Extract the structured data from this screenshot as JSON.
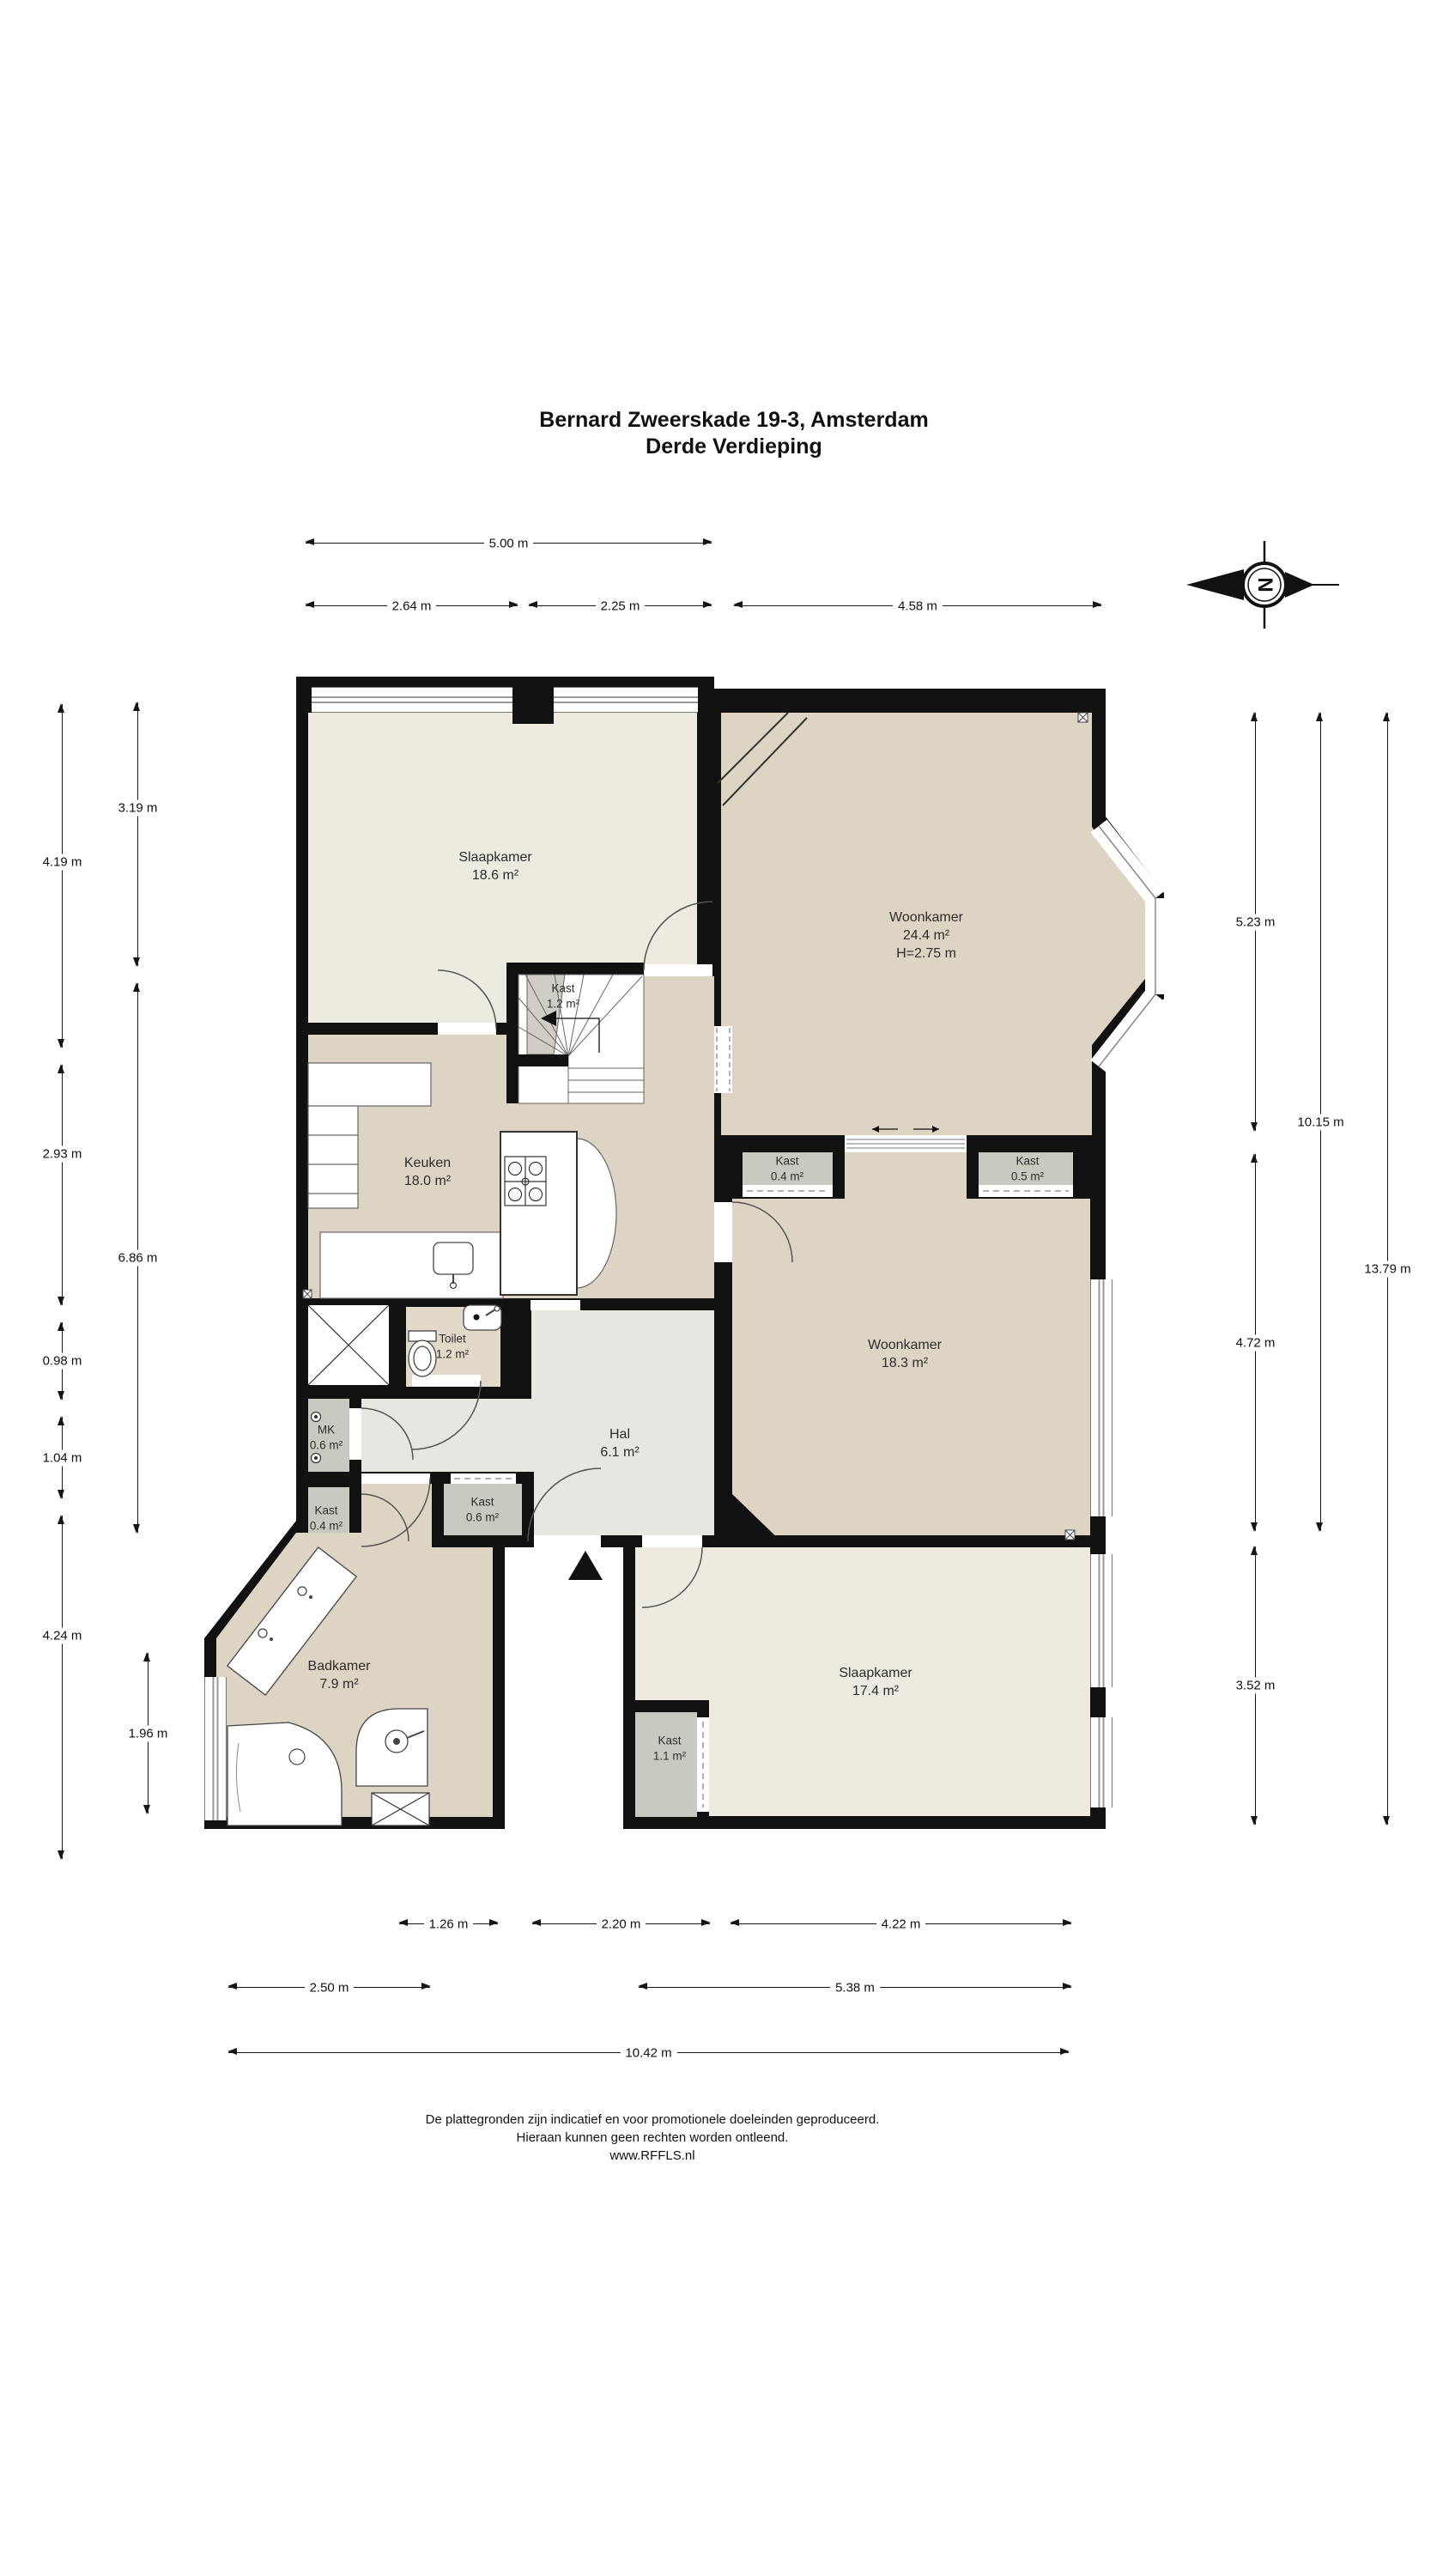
{
  "title": {
    "line1": "Bernard Zweerskade 19-3, Amsterdam",
    "line2": "Derde Verdieping"
  },
  "compass": {
    "letter": "N"
  },
  "rooms": {
    "slaapkamer1": {
      "name": "Slaapkamer",
      "area": "18.6 m²"
    },
    "woonkamer1": {
      "name": "Woonkamer",
      "area": "24.4 m²",
      "height": "H=2.75 m"
    },
    "kast12": {
      "name": "Kast",
      "area": "1.2 m²"
    },
    "keuken": {
      "name": "Keuken",
      "area": "18.0 m²"
    },
    "kast04a": {
      "name": "Kast",
      "area": "0.4 m²"
    },
    "kast05": {
      "name": "Kast",
      "area": "0.5 m²"
    },
    "woonkamer2": {
      "name": "Woonkamer",
      "area": "18.3 m²"
    },
    "toilet": {
      "name": "Toilet",
      "area": "1.2 m²"
    },
    "mk": {
      "name": "MK",
      "area": "0.6 m²"
    },
    "hal": {
      "name": "Hal",
      "area": "6.1 m²"
    },
    "kast04b": {
      "name": "Kast",
      "area": "0.4 m²"
    },
    "kast06": {
      "name": "Kast",
      "area": "0.6 m²"
    },
    "badkamer": {
      "name": "Badkamer",
      "area": "7.9 m²"
    },
    "slaapkamer2": {
      "name": "Slaapkamer",
      "area": "17.4 m²"
    },
    "kast11": {
      "name": "Kast",
      "area": "1.1 m²"
    }
  },
  "dimensions": {
    "top": [
      {
        "label": "5.00 m"
      },
      {
        "label": "2.64 m"
      },
      {
        "label": "2.25 m"
      },
      {
        "label": "4.58 m"
      }
    ],
    "left": [
      {
        "label": "4.19 m"
      },
      {
        "label": "2.93 m"
      },
      {
        "label": "0.98 m"
      },
      {
        "label": "1.04 m"
      },
      {
        "label": "4.24 m"
      },
      {
        "label": "3.19 m"
      },
      {
        "label": "6.86 m"
      },
      {
        "label": "1.96 m"
      }
    ],
    "right": [
      {
        "label": "5.23 m"
      },
      {
        "label": "4.72 m"
      },
      {
        "label": "3.52 m"
      },
      {
        "label": "10.15 m"
      },
      {
        "label": "13.79 m"
      }
    ],
    "bottom": [
      {
        "label": "1.26 m"
      },
      {
        "label": "2.20 m"
      },
      {
        "label": "4.22 m"
      },
      {
        "label": "2.50 m"
      },
      {
        "label": "5.38 m"
      },
      {
        "label": "10.42 m"
      }
    ]
  },
  "footer": {
    "line1": "De plattegronden zijn indicatief en voor promotionele doeleinden geproduceerd.",
    "line2": "Hieraan kunnen geen rechten worden ontleend.",
    "line3": "www.RFFLS.nl"
  },
  "colors": {
    "wall": "#111111",
    "room_tan": "#ddd4c3",
    "room_light": "#edeae0",
    "hal": "#e8e6e0",
    "closet": "#c9c9c1",
    "toilet": "#e2d9c9"
  }
}
